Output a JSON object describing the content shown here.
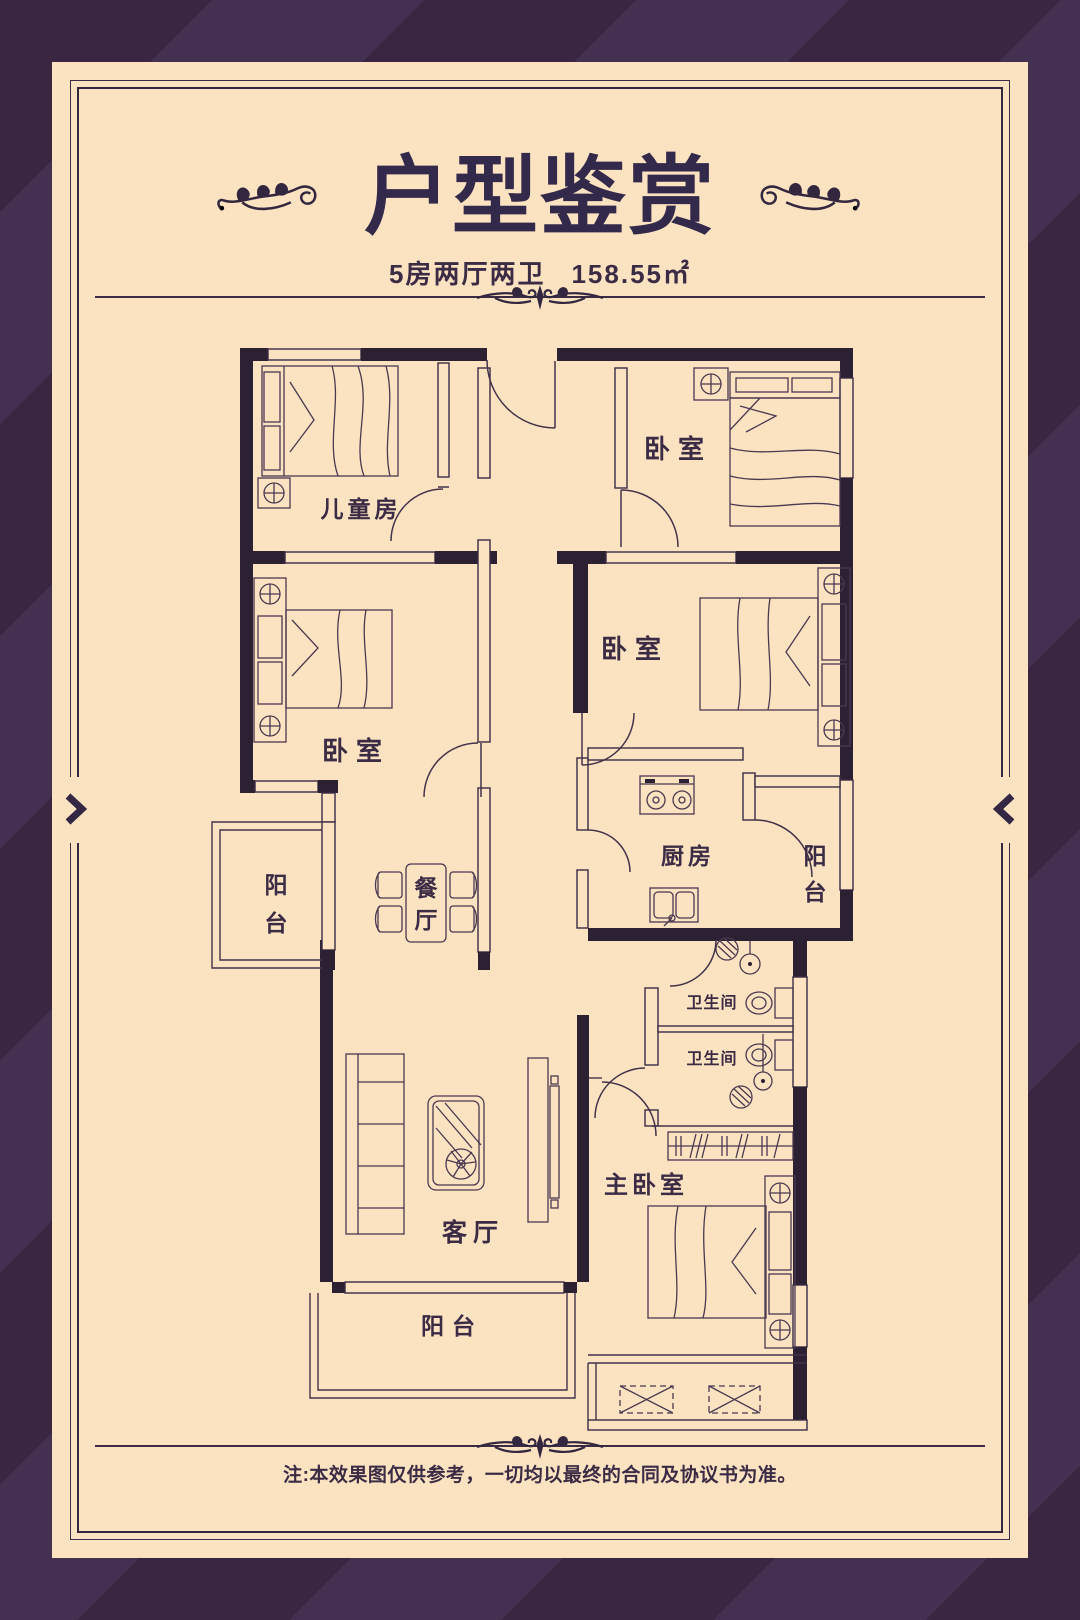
{
  "theme": {
    "background": "#3a2641",
    "background_stripe": "#443051",
    "card": "#fbe3c2",
    "ink": "#3b2b45",
    "wall": "#2c2033"
  },
  "header": {
    "title": "户型鉴赏",
    "subtitle": {
      "layout": "5房两厅两卫",
      "area": "158.55㎡"
    }
  },
  "floorplan": {
    "rooms": {
      "children_room": {
        "label": "儿童房"
      },
      "bedroom_top_right": {
        "label": "卧室"
      },
      "bedroom_mid_left": {
        "label": "卧室"
      },
      "bedroom_mid_right": {
        "label": "卧室"
      },
      "kitchen": {
        "label": "厨房"
      },
      "balcony_right": {
        "label": "阳台",
        "chars": [
          "阳",
          "台"
        ]
      },
      "balcony_left": {
        "label": "阳台",
        "chars": [
          "阳",
          "台"
        ]
      },
      "dining": {
        "label": "餐厅",
        "chars": [
          "餐",
          "厅"
        ]
      },
      "bathroom_upper": {
        "label": "卫生间"
      },
      "bathroom_lower": {
        "label": "卫生间"
      },
      "master_bedroom": {
        "label": "主卧室"
      },
      "living_room": {
        "label": "客厅"
      },
      "balcony_bottom": {
        "label": "阳台"
      }
    }
  },
  "footer": {
    "note": "注:本效果图仅供参考，一切均以最终的合同及协议书为准。"
  }
}
